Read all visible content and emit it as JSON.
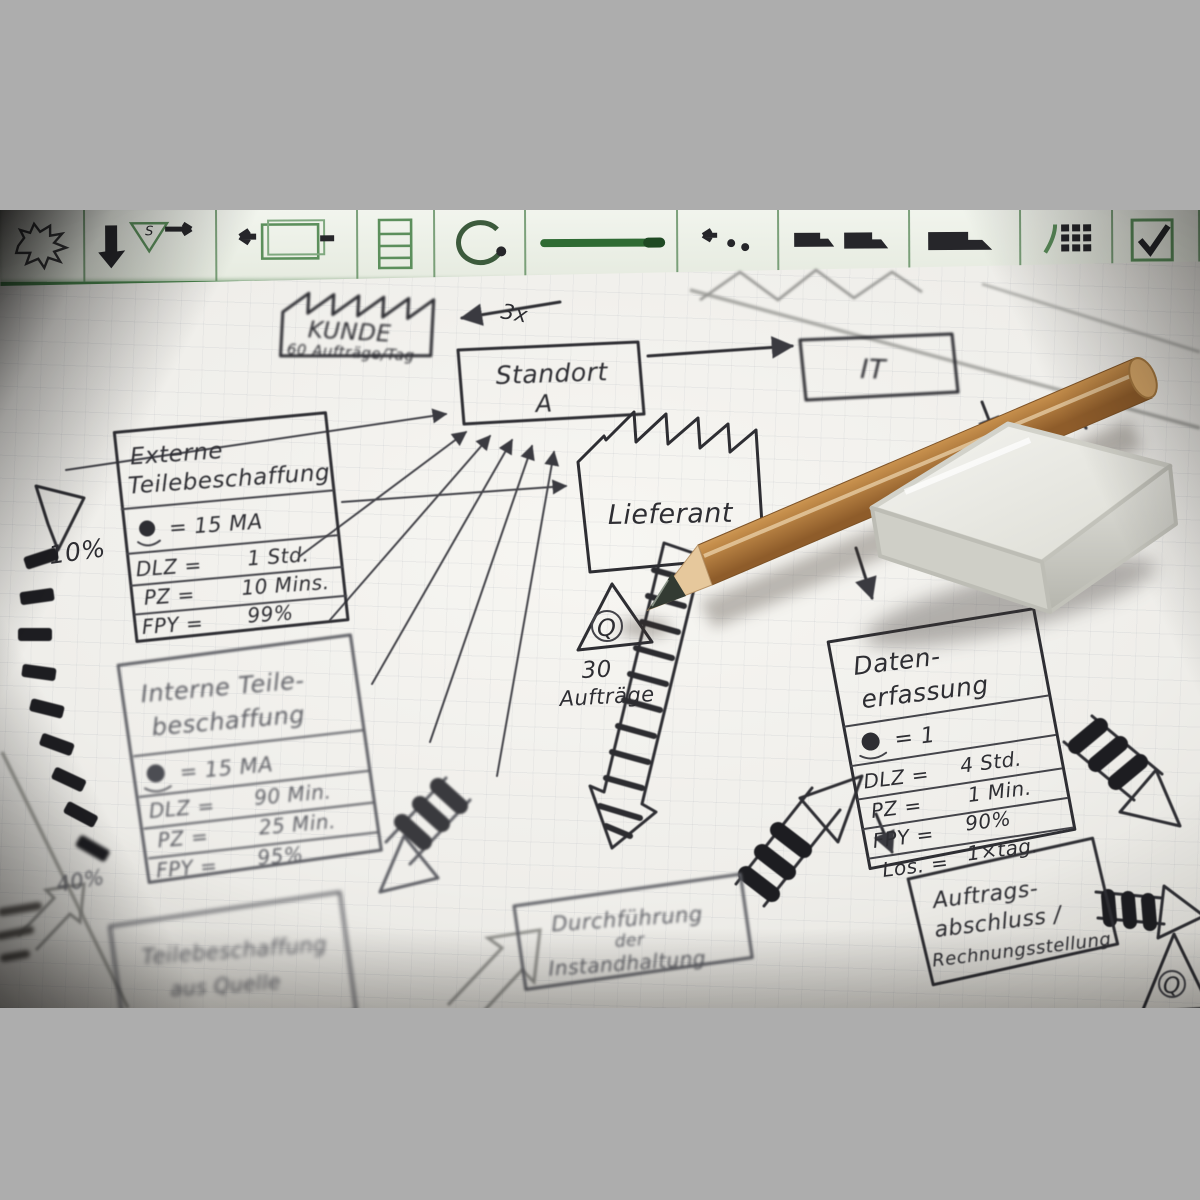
{
  "photo": {
    "border_color": "#adadad",
    "paper_color": "#f3f2ee",
    "ink_color": "#2e2e33",
    "accent_green": "#47804a"
  },
  "toolbar": {
    "s_label": "S",
    "icons": [
      "kaizen-burst",
      "supermarket-kanban",
      "shipment-box",
      "rack",
      "withdrawal-loop",
      "push-line",
      "electronic-info",
      "truck-pair",
      "truck",
      "keypad",
      "checkbox"
    ]
  },
  "diagram": {
    "kunde": {
      "title": "KUNDE",
      "subtitle": "60 Aufträge/Tag"
    },
    "flow_label": "3x",
    "standort": {
      "line1": "Standort",
      "line2": "A"
    },
    "it": {
      "label": "IT"
    },
    "lieferant": {
      "label": "Lieferant"
    },
    "externe": {
      "title1": "Externe",
      "title2": "Teilebeschaffung",
      "operator_eq": "= 15 MA",
      "rows": [
        {
          "label": "DLZ =",
          "value": "1 Std."
        },
        {
          "label": "PZ =",
          "value": "10 Mins."
        },
        {
          "label": "FPY =",
          "value": "99%"
        }
      ]
    },
    "pct_left": "10%",
    "interne": {
      "title1": "Interne Teile-",
      "title2": "beschaffung",
      "operator_eq": "= 15 MA",
      "rows": [
        {
          "label": "DLZ =",
          "value": "90 Min."
        },
        {
          "label": "PZ =",
          "value": "25 Min."
        },
        {
          "label": "FPY =",
          "value": "95%"
        }
      ]
    },
    "queue1": {
      "symbol": "Q",
      "line1": "30",
      "line2": "Aufträge"
    },
    "daten": {
      "title1": "Daten-",
      "title2": "erfassung",
      "operator_eq": "= 1",
      "rows": [
        {
          "label": "DLZ =",
          "value": "4 Std."
        },
        {
          "label": "PZ =",
          "value": "1 Min."
        },
        {
          "label": "FPY =",
          "value": "90%"
        },
        {
          "label": "Los. =",
          "value": "1×täg."
        }
      ]
    },
    "auftrag": {
      "line1": "Auftrags-",
      "line2": "abschluss /",
      "line3": "Rechnungsstellung"
    },
    "durchfuehrung": {
      "line1": "Durchführung",
      "line2": "der",
      "line3": "Instandhaltung"
    },
    "teile_unten": {
      "line1": "Teilebeschaffung",
      "line2": "aus Quelle"
    },
    "pct_left2": "40%",
    "queue2": {
      "symbol": "Q"
    }
  }
}
